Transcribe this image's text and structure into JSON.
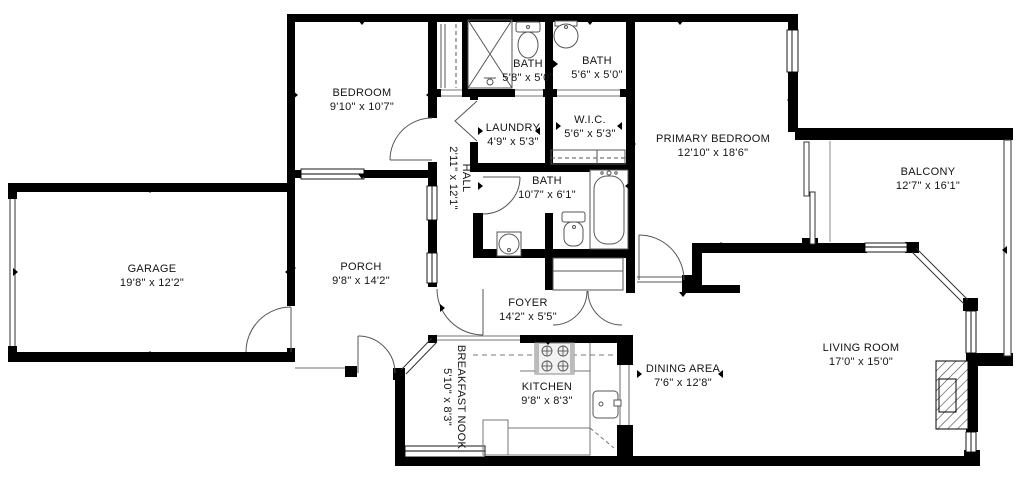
{
  "plan": {
    "type": "residential-floor-plan",
    "colors": {
      "wall": "#000000",
      "fixture_line": "#555555",
      "text": "#141414",
      "background": "#ffffff"
    }
  },
  "rooms": [
    {
      "id": "bedroom",
      "name": "BEDROOM",
      "dims": "9'10\" x 10'7\""
    },
    {
      "id": "bath-top-left",
      "name": "BATH",
      "dims": "5'8\" x 5'0\""
    },
    {
      "id": "bath-top-right",
      "name": "BATH",
      "dims": "5'6\" x 5'0\""
    },
    {
      "id": "laundry",
      "name": "LAUNDRY",
      "dims": "4'9\" x 5'3\""
    },
    {
      "id": "wic",
      "name": "W.I.C.",
      "dims": "5'6\" x 5'3\""
    },
    {
      "id": "primary-bedroom",
      "name": "PRIMARY BEDROOM",
      "dims": "12'10\" x 18'6\""
    },
    {
      "id": "balcony",
      "name": "BALCONY",
      "dims": "12'7\" x 16'1\""
    },
    {
      "id": "hall",
      "name": "HALL",
      "dims": "2'11\" x 12'1\""
    },
    {
      "id": "bath-main",
      "name": "BATH",
      "dims": "10'7\" x 6'1\""
    },
    {
      "id": "garage",
      "name": "GARAGE",
      "dims": "19'8\" x 12'2\""
    },
    {
      "id": "porch",
      "name": "PORCH",
      "dims": "9'8\" x 14'2\""
    },
    {
      "id": "foyer",
      "name": "FOYER",
      "dims": "14'2\" x 5'5\""
    },
    {
      "id": "breakfast-nook",
      "name": "BREAKFAST NOOK",
      "dims": "5'10\" x 8'3\""
    },
    {
      "id": "kitchen",
      "name": "KITCHEN",
      "dims": "9'8\" x 8'3\""
    },
    {
      "id": "dining-area",
      "name": "DINING AREA",
      "dims": "7'6\" x 12'8\""
    },
    {
      "id": "living-room",
      "name": "LIVING ROOM",
      "dims": "17'0\" x 15'0\""
    }
  ]
}
